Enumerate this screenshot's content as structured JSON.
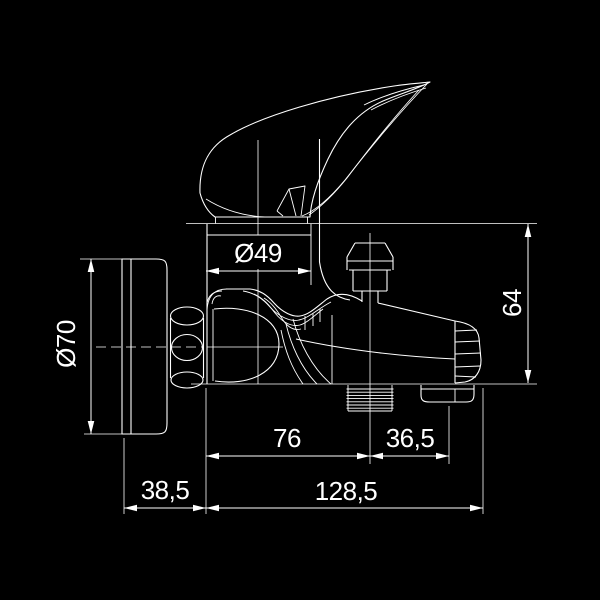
{
  "drawing": {
    "subject": "Wall-mounted single-lever bath mixer tap, side view technical dimension drawing",
    "style": {
      "background": "#000000",
      "line_color": "#ffffff"
    },
    "dimensions": {
      "d49": "Ø49",
      "d70": "Ø70",
      "d64": "64",
      "d76": "76",
      "d36_5": "36,5",
      "d38_5": "38,5",
      "d128_5": "128,5"
    }
  }
}
